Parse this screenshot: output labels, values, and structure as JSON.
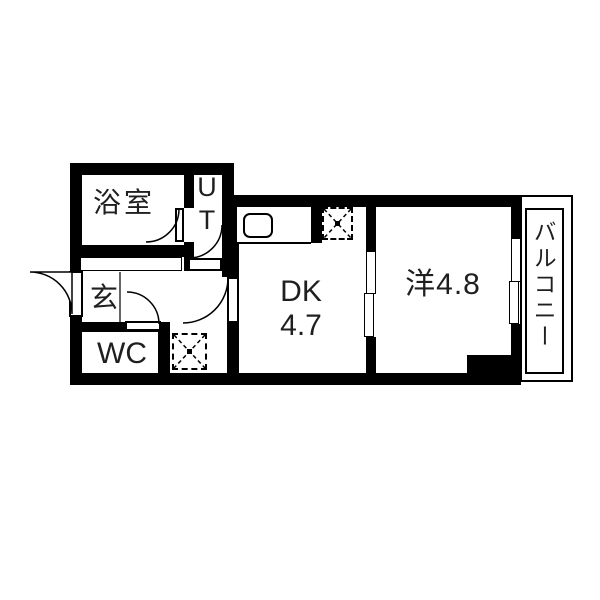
{
  "floor_plan": {
    "rooms": {
      "bathroom": {
        "label": "浴室"
      },
      "utility": {
        "label": "UT"
      },
      "entrance": {
        "label": "玄"
      },
      "toilet": {
        "label": "WC"
      },
      "dining_kitchen": {
        "label": "DK",
        "area": "4.7"
      },
      "western_room": {
        "label": "洋4.8"
      },
      "balcony": {
        "label": "バルコニー"
      }
    },
    "fixtures": {
      "kitchen_sink": "sink-icon",
      "refrigerator_space": "dashed-x-box-icon",
      "washer_space": "dashed-x-box-icon",
      "hinged_doors": 5,
      "sliding_door_panels": 2,
      "window_panels": 2
    },
    "colors": {
      "wall": "#000000",
      "text": "#1f1f1f",
      "background": "#ffffff"
    }
  }
}
